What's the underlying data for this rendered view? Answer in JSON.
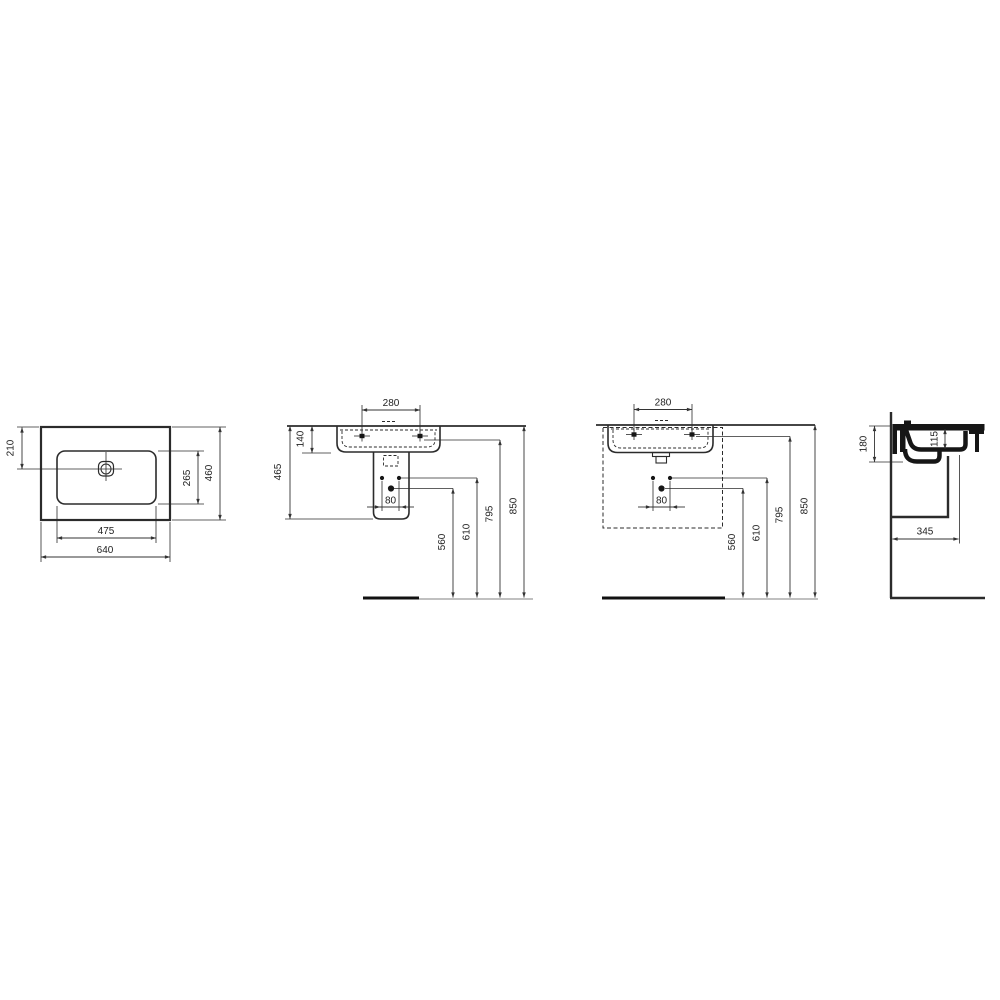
{
  "colors": {
    "line": "#2b2b2b",
    "light_line": "#9b9b9b",
    "section_fill": "#161616",
    "background": "#ffffff",
    "text": "#222222"
  },
  "views": {
    "plan": {
      "name": "plan view",
      "dims": {
        "drain_center_from_back": "210",
        "bowl_depth": "265",
        "overall_depth": "460",
        "bowl_width": "475",
        "overall_width": "640"
      }
    },
    "front_pedestal": {
      "name": "front view with semi-pedestal",
      "dims": {
        "tap_hole_centres": "280",
        "front_apron_height": "140",
        "basin_with_shroud_height": "465",
        "fixing_hole_centres": "80",
        "trap_outlet_height": "560",
        "fixing_bolt_height": "610",
        "tap_hole_height": "795",
        "rim_height": "850"
      }
    },
    "front_furniture": {
      "name": "front view with furniture outline",
      "dims": {
        "tap_hole_centres": "280",
        "fixing_hole_centres": "80",
        "trap_outlet_height": "560",
        "fixing_bolt_height": "610",
        "tap_hole_height": "795",
        "rim_height": "850"
      }
    },
    "side": {
      "name": "side section view",
      "dims": {
        "back_section_height": "180",
        "bowl_inner_depth": "115",
        "projection_from_wall": "345"
      }
    }
  }
}
